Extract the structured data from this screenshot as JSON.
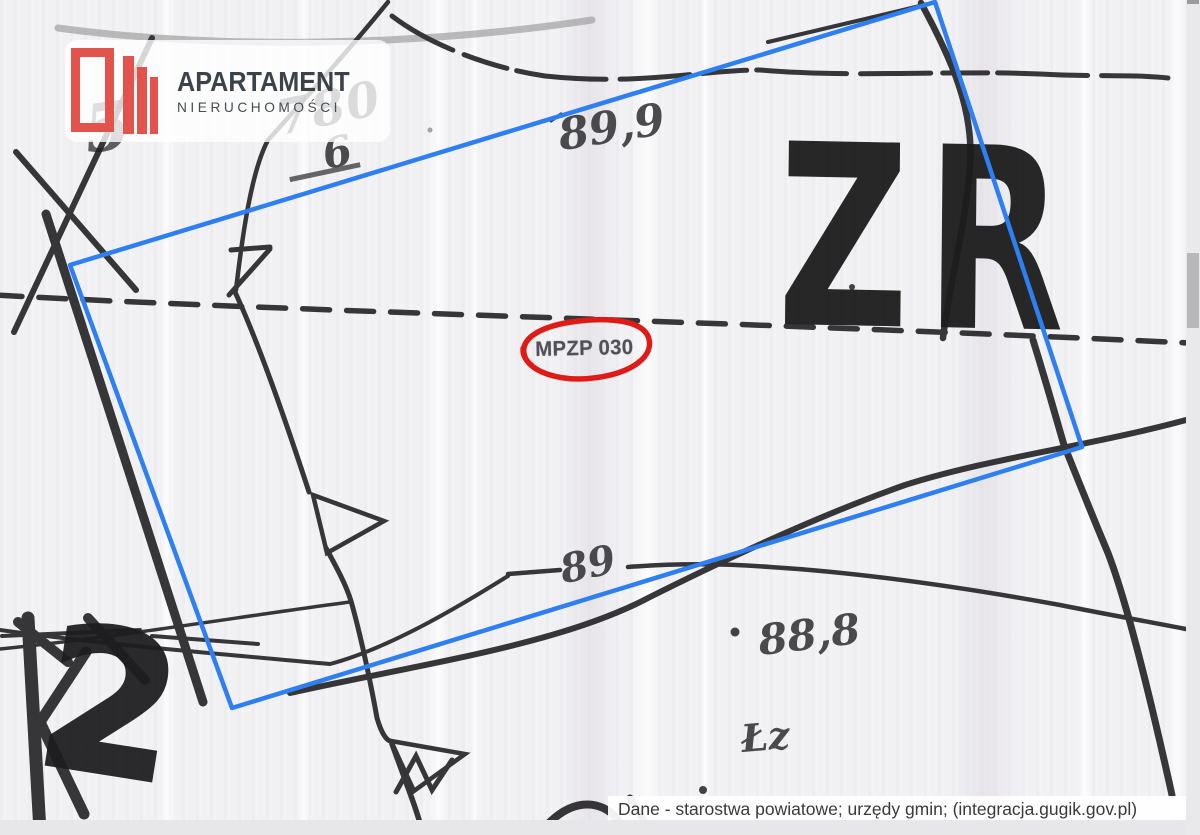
{
  "branding": {
    "logo_title": "APARTAMENT",
    "logo_subtitle": "NIERUCHOMOŚCI",
    "logo_color": "#e2544b"
  },
  "map": {
    "boundary_color": "#2d7ff2",
    "highlight_color": "#de1b15",
    "ink_color": "#1d1d1f",
    "labels": {
      "zone_large": "ZR",
      "zone_circled": "MPZP 030",
      "parcel_numerator": "780",
      "parcel_denominator": "6",
      "elevation_top": "89,9",
      "contour_label": "89",
      "spot_elevation": "88,8",
      "land_use_small": "Łz",
      "land_use_corner_digit": "2",
      "plot_number_left": "5"
    }
  },
  "attribution": {
    "text": "Dane - starostwa powiatowe; urzędy gmin; (integracja.gugik.gov.pl)"
  }
}
